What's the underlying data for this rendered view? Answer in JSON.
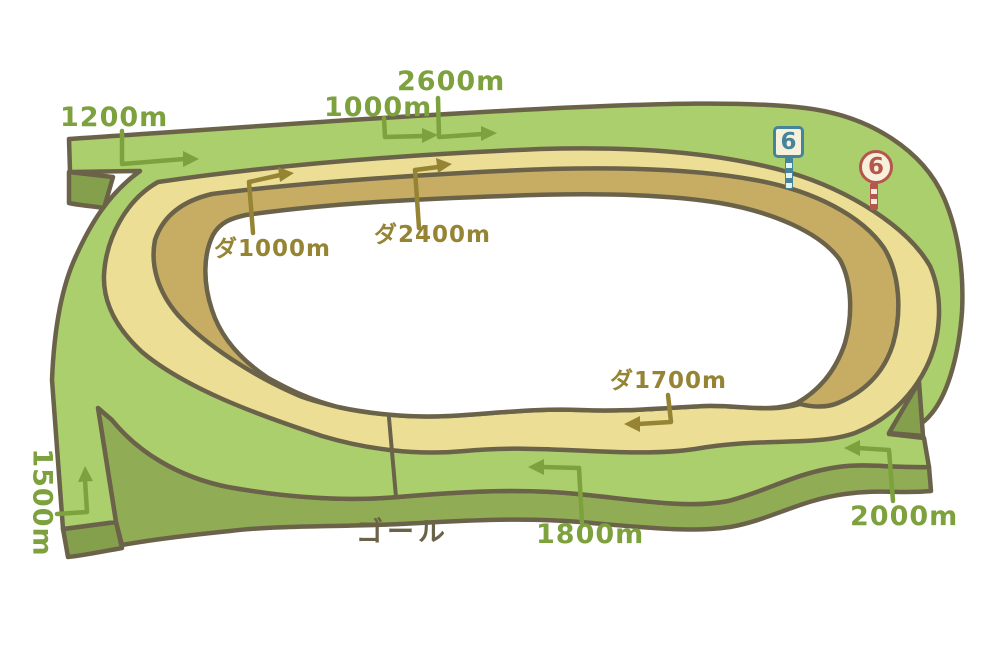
{
  "labels": {
    "t1200": "1200m",
    "t1000": "1000m",
    "t2600": "2600m",
    "t1500": "1500m",
    "t1800": "1800m",
    "t2000": "2000m",
    "d1000": "ダ1000m",
    "d2400": "ダ2400m",
    "d1700": "ダ1700m",
    "goal": "ゴール"
  },
  "markers": {
    "blue": {
      "value": "6",
      "shape": "square",
      "color": "#45849b"
    },
    "red": {
      "value": "6",
      "shape": "round",
      "color": "#b5574d"
    }
  },
  "colors": {
    "turf": "#abcf6d",
    "turf-side": "#90ad55",
    "turf-dark": "#84a04c",
    "dirt": "#ecdf95",
    "dirt-lip": "#c7ad64",
    "outline": "#6b6349",
    "turf-text": "#7ca13d",
    "dirt-text": "#958434",
    "sign-cream": "#f7f0da",
    "sign-blue": "#45849b",
    "sign-red": "#b5574d"
  }
}
